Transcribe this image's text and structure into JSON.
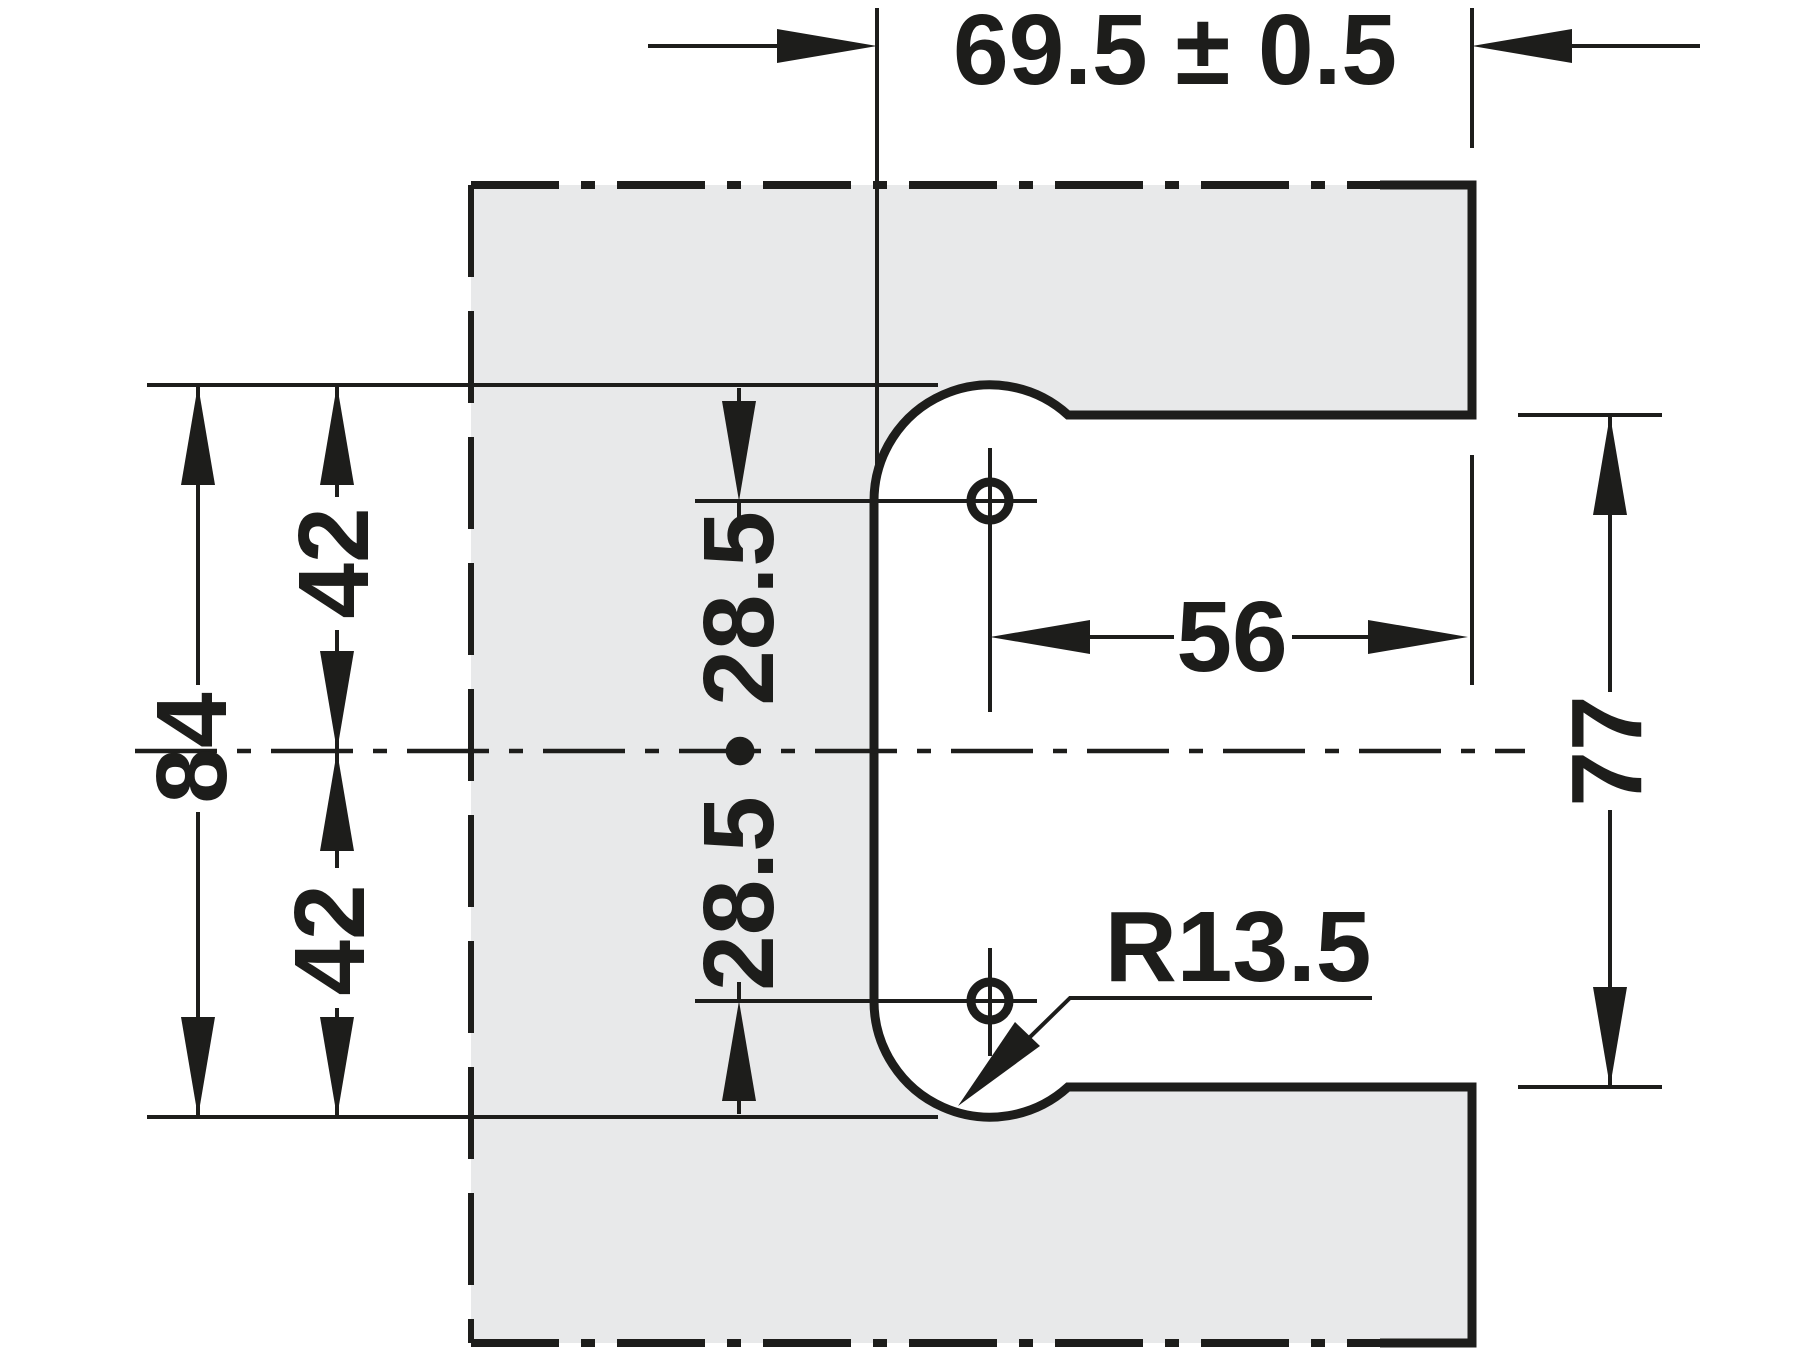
{
  "drawing": {
    "description": "Panel cut-out technical drawing with C-shaped notch, two drill holes and radius corner",
    "labels": {
      "width": "69.5 ± 0.5",
      "total_height": "84",
      "upper_offset": "42",
      "lower_offset": "42",
      "hole_pair": "28.5 • 28.5",
      "hole_to_edge": "56",
      "opening_height": "77",
      "corner_radius": "R13.5"
    },
    "colors": {
      "line": "#1d1d1b",
      "panel_fill": "#e8e9ea",
      "background": "#ffffff"
    }
  }
}
